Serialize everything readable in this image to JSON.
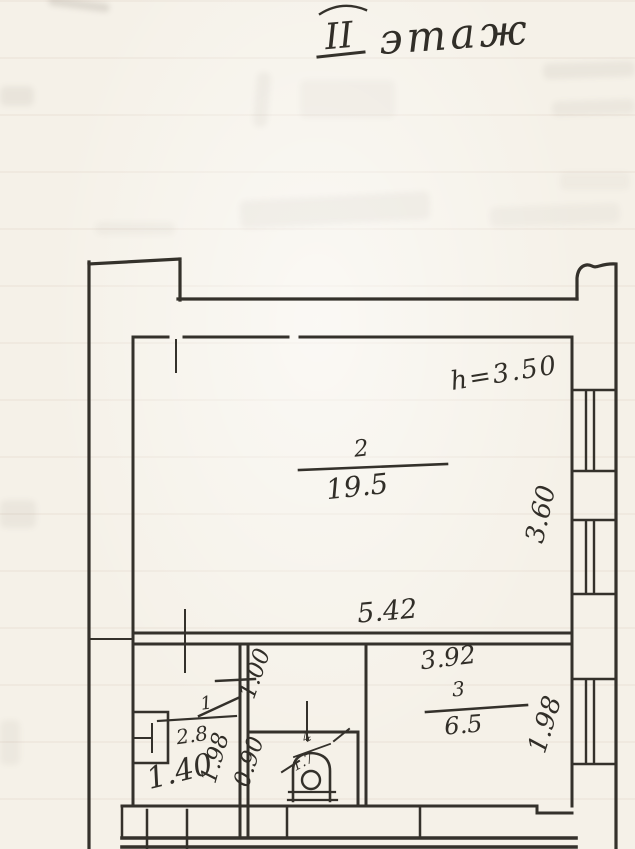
{
  "title": {
    "floor_numeral": "II",
    "floor_word": "этаж"
  },
  "annotations": {
    "ceiling_height": "h=3.50"
  },
  "rooms": [
    {
      "number": "2",
      "area": "19.5"
    },
    {
      "number": "3",
      "area": "6.5"
    },
    {
      "number": "1",
      "area": "2.8"
    },
    {
      "number": "4",
      "area": "1.7"
    }
  ],
  "dimensions": {
    "room2_width": "5.42",
    "room3_width": "3.92",
    "right_wall_upper": "3.60",
    "right_wall_lower": "1.98",
    "hallway_upper": "1.00",
    "hallway_lower": "0.90",
    "room1_right": "1.98",
    "room1_bottom": "1.40"
  },
  "icons": [
    "toilet-icon",
    "window-icon",
    "vent-duct-icon"
  ],
  "colors": {
    "ink": "#34312b",
    "paper": "#f5f1e8"
  }
}
